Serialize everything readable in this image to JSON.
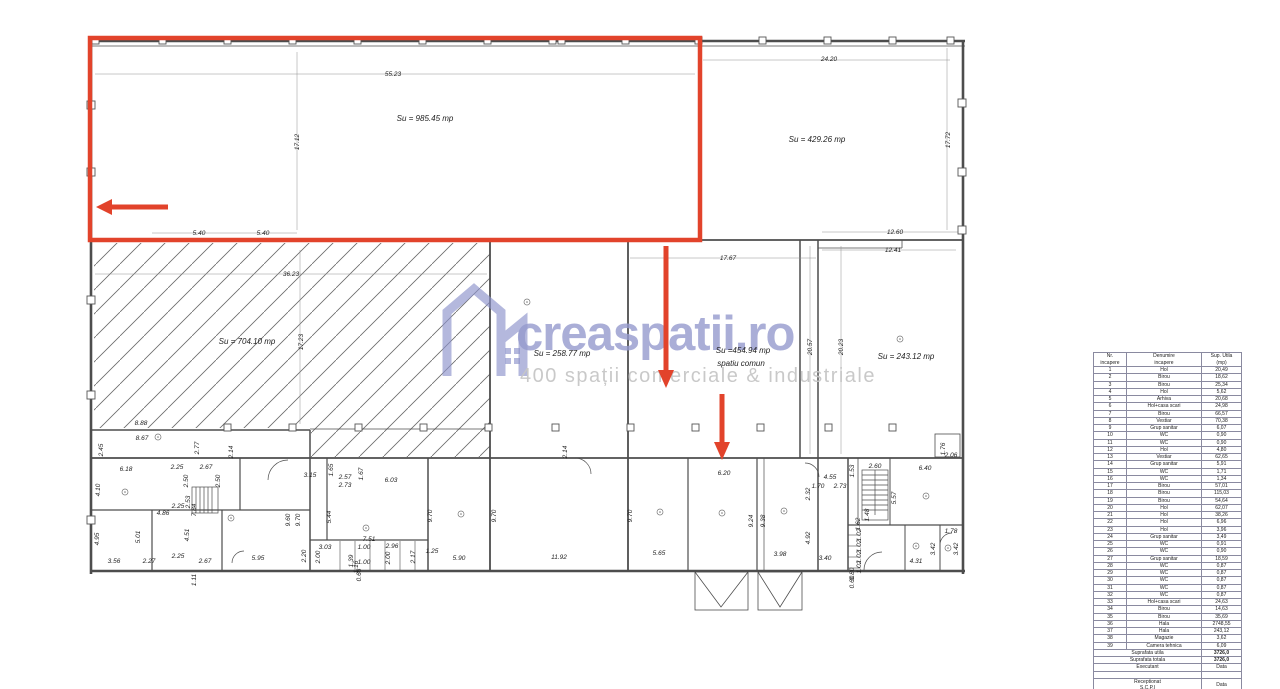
{
  "watermark": {
    "brand": "creaspatii.ro",
    "tagline": "400 spații comerciale & industriale",
    "brand_color": "#959bce",
    "tagline_color": "#c7c7c7"
  },
  "highlight": {
    "color": "#e2432b"
  },
  "plan": {
    "su_labels": [
      [
        "Su = 985.45 mp",
        425,
        121
      ],
      [
        "Su = 429.26 mp",
        817,
        142
      ],
      [
        "Su = 704.10 mp",
        247,
        344
      ],
      [
        "Su = 258.77 mp",
        562,
        356
      ],
      [
        "Su =454.94 mp",
        743,
        353
      ],
      [
        "spatiu comun",
        741,
        366
      ],
      [
        "Su = 243.12 mp",
        906,
        359
      ]
    ],
    "dim_labels": [
      [
        "55.23",
        393,
        76
      ],
      [
        "17.12",
        299,
        142,
        1
      ],
      [
        "5.40",
        199,
        235
      ],
      [
        "5.40",
        263,
        235
      ],
      [
        "24.20",
        829,
        61
      ],
      [
        "17.72",
        950,
        140,
        1
      ],
      [
        "12.60",
        895,
        234
      ],
      [
        "12.41",
        893,
        252
      ],
      [
        "17.67",
        728,
        260
      ],
      [
        "36.23",
        291,
        276
      ],
      [
        "17.23",
        303,
        342,
        1
      ],
      [
        "20.57",
        812,
        347,
        1
      ],
      [
        "20.23",
        843,
        347,
        1
      ],
      [
        "8.88",
        141,
        425
      ],
      [
        "8.67",
        142,
        440
      ],
      [
        "2.45",
        103,
        450,
        1
      ],
      [
        "2.77",
        199,
        448,
        1
      ],
      [
        "2.14",
        233,
        452,
        1
      ],
      [
        "2.14",
        567,
        452,
        1
      ],
      [
        "1.76",
        945,
        449,
        1
      ],
      [
        "2.06",
        951,
        457
      ],
      [
        "6.18",
        126,
        471
      ],
      [
        "2.25",
        177,
        469
      ],
      [
        "2.67",
        206,
        469
      ],
      [
        "2.50",
        188,
        481,
        1
      ],
      [
        "2.50",
        220,
        481,
        1
      ],
      [
        "3.15",
        310,
        477
      ],
      [
        "1.65",
        333,
        470,
        1
      ],
      [
        "2.57",
        345,
        479
      ],
      [
        "1.67",
        363,
        474,
        1
      ],
      [
        "2.73",
        345,
        487
      ],
      [
        "6.03",
        391,
        482
      ],
      [
        "4.10",
        100,
        490,
        1
      ],
      [
        "2.53",
        190,
        502,
        1
      ],
      [
        "7.84",
        196,
        510,
        1
      ],
      [
        "2.25",
        178,
        508
      ],
      [
        "4.86",
        163,
        515
      ],
      [
        "5.44",
        331,
        517,
        1
      ],
      [
        "9.60",
        290,
        520,
        1
      ],
      [
        "9.70",
        300,
        520,
        1
      ],
      [
        "9.70",
        432,
        516,
        1
      ],
      [
        "9.70",
        496,
        516,
        1
      ],
      [
        "9.70",
        632,
        516,
        1
      ],
      [
        "4.95",
        99,
        539,
        1
      ],
      [
        "5.01",
        140,
        537,
        1
      ],
      [
        "4.51",
        189,
        535,
        1
      ],
      [
        "7.51",
        369,
        541
      ],
      [
        "3.03",
        325,
        549
      ],
      [
        "2.20",
        306,
        556,
        1
      ],
      [
        "2.00",
        320,
        557,
        1
      ],
      [
        "1.00",
        364,
        549
      ],
      [
        "2.96",
        392,
        548
      ],
      [
        "2.00",
        390,
        558,
        1
      ],
      [
        "2.17",
        415,
        557,
        1
      ],
      [
        "1.25",
        432,
        553
      ],
      [
        "5.95",
        258,
        560
      ],
      [
        "5.90",
        459,
        560
      ],
      [
        "11.92",
        559,
        559
      ],
      [
        "5.65",
        659,
        555
      ],
      [
        "6.20",
        724,
        475
      ],
      [
        "9.24",
        753,
        521,
        1
      ],
      [
        "9.38",
        765,
        521,
        1
      ],
      [
        "3.98",
        780,
        556
      ],
      [
        "3.40",
        825,
        560
      ],
      [
        "4.92",
        810,
        538,
        1
      ],
      [
        "2.32",
        810,
        494,
        1
      ],
      [
        "1.70",
        818,
        488
      ],
      [
        "4.55",
        830,
        479
      ],
      [
        "2.73",
        840,
        488
      ],
      [
        "1.53",
        854,
        471,
        1
      ],
      [
        "2.60",
        875,
        468
      ],
      [
        "6.40",
        925,
        470
      ],
      [
        "5.57",
        896,
        498,
        1
      ],
      [
        "1.48",
        869,
        515,
        1
      ],
      [
        "1.62",
        860,
        524,
        1
      ],
      [
        "1.02",
        861,
        535,
        1
      ],
      [
        "1.02",
        861,
        546,
        1
      ],
      [
        "1.02",
        861,
        557,
        1
      ],
      [
        "1.02",
        861,
        567,
        1
      ],
      [
        "1.78",
        951,
        533
      ],
      [
        "3.42",
        935,
        549,
        1
      ],
      [
        "3.42",
        958,
        549,
        1
      ],
      [
        "4.31",
        916,
        563
      ],
      [
        "3.56",
        114,
        563
      ],
      [
        "2.27",
        149,
        563
      ],
      [
        "2.25",
        178,
        558
      ],
      [
        "2.67",
        205,
        563
      ],
      [
        "1.11",
        196,
        580,
        1
      ],
      [
        "1.39",
        353,
        561,
        1
      ],
      [
        "1.16",
        358,
        567,
        1
      ],
      [
        "1.00",
        364,
        564
      ],
      [
        "0.66",
        361,
        575,
        1
      ],
      [
        "0.80",
        854,
        574,
        1
      ],
      [
        "0.60",
        854,
        582,
        1
      ]
    ]
  },
  "table": {
    "headers": {
      "col1": [
        "Nr.",
        "incapere"
      ],
      "col2": [
        "Denumire",
        "incapere"
      ],
      "col3": [
        "Sup. Utila",
        "(mp)"
      ]
    },
    "rows": [
      [
        "1",
        "Hol",
        "20,49"
      ],
      [
        "2",
        "Birou",
        "18,62"
      ],
      [
        "3",
        "Birou",
        "25,34"
      ],
      [
        "4",
        "Hol",
        "5,62"
      ],
      [
        "5",
        "Arhiva",
        "20,68"
      ],
      [
        "6",
        "Hol+casa scari",
        "24,98"
      ],
      [
        "7",
        "Birou",
        "66,57"
      ],
      [
        "8",
        "Vestiar",
        "70,38"
      ],
      [
        "9",
        "Grup sanitar",
        "6,07"
      ],
      [
        "10",
        "WC",
        "0,90"
      ],
      [
        "11",
        "WC",
        "0,90"
      ],
      [
        "12",
        "Hol",
        "4,80"
      ],
      [
        "13",
        "Vestiar",
        "62,65"
      ],
      [
        "14",
        "Grup sanitar",
        "5,91"
      ],
      [
        "15",
        "WC",
        "1,71"
      ],
      [
        "16",
        "WC",
        "1,34"
      ],
      [
        "17",
        "Birou",
        "57,01"
      ],
      [
        "18",
        "Birou",
        "115,03"
      ],
      [
        "19",
        "Birou",
        "54,64"
      ],
      [
        "20",
        "Hol",
        "62,07"
      ],
      [
        "21",
        "Hol",
        "38,26"
      ],
      [
        "22",
        "Hol",
        "6,96"
      ],
      [
        "23",
        "Hol",
        "3,96"
      ],
      [
        "24",
        "Grup sanitar",
        "3,49"
      ],
      [
        "25",
        "WC",
        "0,91"
      ],
      [
        "26",
        "WC",
        "0,90"
      ],
      [
        "27",
        "Grup sanitar",
        "18,59"
      ],
      [
        "28",
        "WC",
        "0,87"
      ],
      [
        "29",
        "WC",
        "0,87"
      ],
      [
        "30",
        "WC",
        "0,87"
      ],
      [
        "31",
        "WC",
        "0,87"
      ],
      [
        "32",
        "WC",
        "0,87"
      ],
      [
        "33",
        "Hol+casa scari",
        "24,63"
      ],
      [
        "34",
        "Birou",
        "14,63"
      ],
      [
        "35",
        "Birou",
        "35,69"
      ],
      [
        "36",
        "Hala",
        "2748,55"
      ],
      [
        "37",
        "Hala",
        "243,12"
      ],
      [
        "38",
        "Magazie",
        "3,62"
      ],
      [
        "39",
        "Camera tehnica",
        "6,09"
      ]
    ],
    "summary": [
      [
        "Suprafata utila",
        "3726,0"
      ],
      [
        "Suprafata totala",
        "3726,0"
      ]
    ],
    "footer": [
      {
        "label": "Executant",
        "label2": "",
        "value": "Data"
      },
      {
        "label": "",
        "label2": "",
        "value": ""
      },
      {
        "label": "Receptionat",
        "label2": "S.C.P.I",
        "value": "Data"
      }
    ]
  }
}
